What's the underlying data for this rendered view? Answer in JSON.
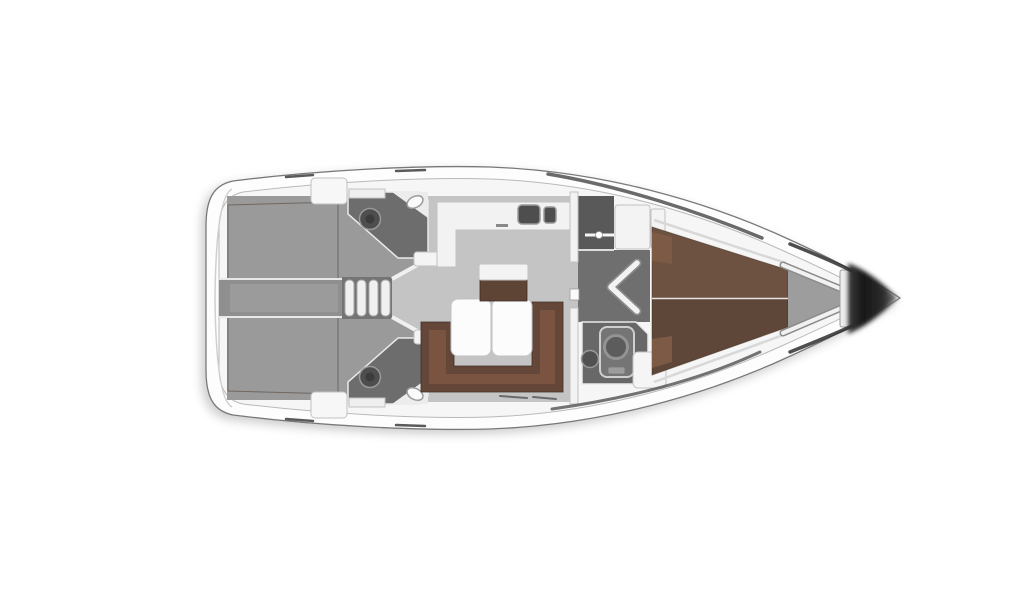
{
  "page": {
    "background": "#ffffff"
  },
  "floorplan": {
    "subject": "sailing-yacht-interior-layout-top-view",
    "bow_direction": "right",
    "rooms": [
      "aft-cabin-starboard",
      "aft-cabin-port",
      "aft-head-starboard",
      "aft-head-port",
      "companionway",
      "saloon",
      "galley",
      "forward-vestibule",
      "forward-head",
      "forward-cabin",
      "anchor-locker",
      "bow"
    ],
    "colors": {
      "hull_fill": "#fdfdfd",
      "deck_fill": "#f6f6f6",
      "floor_saloon": "#c4c4c4",
      "floor_cabin": "#9a9a9a",
      "floor_corridor": "#8f8f8f",
      "floor_corridor_light": "#9b9b9b",
      "floor_steps": "#747474",
      "floor_vestibule": "#6f6f6f",
      "floor_head": "#6d6d6d",
      "floor_fwd_head": "#686868",
      "floor_locker": "#9d9d9d",
      "wet_locker": "#595959",
      "bed_aft": "#5a4337",
      "bed_fwd_upper": "#6d5141",
      "bed_fwd_lower": "#5e4739",
      "pillow": "#7c5a46",
      "sofa_back": "#654739",
      "sofa_seat": "#7a5441",
      "stool": "#5e4435",
      "furniture_white": "#f2f2f2",
      "fixture_dark": "#4e4e4e",
      "shower": "#757575",
      "rail_dark": "#454545"
    }
  }
}
